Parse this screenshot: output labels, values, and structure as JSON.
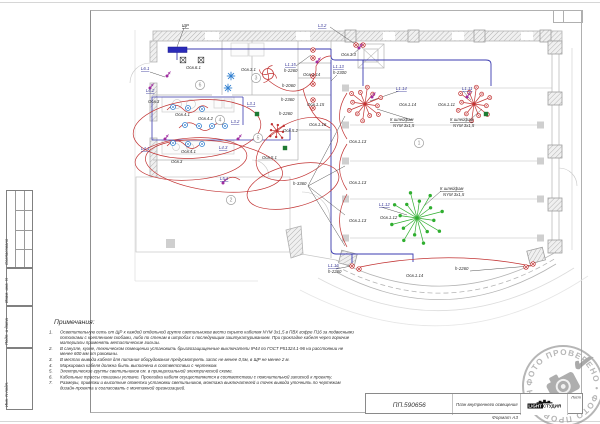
{
  "sheet": {
    "format_label": "Формат А3",
    "corner_box": ""
  },
  "title_block": {
    "doc_number": "ПП.590656",
    "drawing_title": "План внутреннего освещения",
    "logo_word1": "LIGHT",
    "logo_word2": "СТУДИЯ",
    "sheet_cell_label": "Лист"
  },
  "side_stamp": {
    "items": [
      "Согласовано",
      "Взам. инв. N",
      "Подп. и дата",
      "Инв. N подл."
    ]
  },
  "stamp": {
    "text": "ФОТО ПРОВЕРЕНО",
    "icons": [
      "camera-icon",
      "check-icon"
    ]
  },
  "notes": {
    "heading": "Примечания:",
    "items": [
      "Осветительную сеть от ЩР к каждой отдельной группе светильников вести скрыто кабелем NYM 3х1,5 в ПВХ гофре П16 за подвесными потолками с креплением скобами, либо по стенам в штробах с последующим заштукатуриванием. При прокладке кабеля через горючие материалы применять металлические гильзы.",
      "В санузле, кухне, техническом помещении установить брызгозащищенные выключатели IP44 по ГОСТ Р51324.1-96 на расстоянии не менее 600 мм от раковины.",
      "В местах вывода кабеля для питания оборудования предусмотреть запас не менее 0,5м, в ЩР не менее 2 м.",
      "Маркировка кабеля должна быть выполнена в соответствии с чертежом.",
      "Электрические группы светильников см. в принципиальной электрической схеме.",
      "Кабельные трассы показаны условно. Прокладка кабеля осуществляется в соответствии с пояснительной запиской к проекту.",
      "Размеры, привязки и высотные отметки установки светильников, монтажа выключателей и точек вывода уточнить по чертежам дизайн-проекта и согласовать с монтажной организацией."
    ]
  },
  "plan": {
    "colors": {
      "cable_blue": "#3b3bb0",
      "circuit_red": "#c23333",
      "fixture_green": "#2fae2f",
      "switch_magenta": "#a02da0",
      "board_blue": "#2a2ab8"
    },
    "rooms": [
      {
        "n": "1",
        "x": 419,
        "y": 143
      },
      {
        "n": "2",
        "x": 231,
        "y": 200
      },
      {
        "n": "3",
        "x": 256,
        "y": 78
      },
      {
        "n": "4",
        "x": 220,
        "y": 120
      },
      {
        "n": "5",
        "x": 258,
        "y": 138
      },
      {
        "n": "6",
        "x": 200,
        "y": 85
      }
    ],
    "labels": [
      {
        "t": "ЩР",
        "x": 182,
        "y": 27,
        "u": 1
      },
      {
        "t": "L3.2",
        "x": 318,
        "y": 27,
        "u": 1,
        "c": "b"
      },
      {
        "t": "Осв.3.3",
        "x": 341,
        "y": 56
      },
      {
        "t": "Осв.6.1",
        "x": 186,
        "y": 69
      },
      {
        "t": "L6.1",
        "x": 141,
        "y": 70,
        "u": 1,
        "c": "b"
      },
      {
        "t": "L6.2",
        "x": 146,
        "y": 92,
        "u": 1,
        "c": "b"
      },
      {
        "t": "Осв.3.1",
        "x": 241,
        "y": 71
      },
      {
        "t": "L1.15",
        "x": 285,
        "y": 66,
        "u": 1,
        "c": "b"
      },
      {
        "t": "h-2260",
        "x": 284,
        "y": 72
      },
      {
        "t": "h-2060",
        "x": 282,
        "y": 87
      },
      {
        "t": "h-2360",
        "x": 281,
        "y": 101
      },
      {
        "t": "h-2260",
        "x": 279,
        "y": 115
      },
      {
        "t": "Осв.1.14",
        "x": 303,
        "y": 76
      },
      {
        "t": "Осв.1.15",
        "x": 307,
        "y": 106
      },
      {
        "t": "Осв.1.16",
        "x": 309,
        "y": 126
      },
      {
        "t": "L1.13",
        "x": 333,
        "y": 68,
        "u": 1,
        "c": "b"
      },
      {
        "t": "h-2300",
        "x": 333,
        "y": 74
      },
      {
        "t": "Осв.3",
        "x": 148,
        "y": 103
      },
      {
        "t": "Осв.4.1",
        "x": 175,
        "y": 116
      },
      {
        "t": "Осв.4.2",
        "x": 198,
        "y": 120
      },
      {
        "t": "L3.1",
        "x": 247,
        "y": 105,
        "u": 1,
        "c": "b"
      },
      {
        "t": "L3.2",
        "x": 231,
        "y": 123,
        "u": 1,
        "c": "b"
      },
      {
        "t": "Осв.5.2",
        "x": 283,
        "y": 132
      },
      {
        "t": "L4.1",
        "x": 141,
        "y": 150,
        "u": 1,
        "c": "b"
      },
      {
        "t": "Осв.4.1",
        "x": 181,
        "y": 153
      },
      {
        "t": "L4.3",
        "x": 219,
        "y": 149,
        "u": 1,
        "c": "b"
      },
      {
        "t": "Осв.3",
        "x": 171,
        "y": 163
      },
      {
        "t": "Осв.5.1",
        "x": 262,
        "y": 159
      },
      {
        "t": "L5.1",
        "x": 220,
        "y": 180,
        "u": 1,
        "c": "b"
      },
      {
        "t": "L1.14",
        "x": 396,
        "y": 90,
        "u": 1,
        "c": "b"
      },
      {
        "t": "Осв.1.14",
        "x": 399,
        "y": 106
      },
      {
        "t": "К шлейфам",
        "x": 390,
        "y": 121,
        "u": 1
      },
      {
        "t": "NYM 3х1,5",
        "x": 393,
        "y": 127
      },
      {
        "t": "L1.11",
        "x": 462,
        "y": 90,
        "u": 1,
        "c": "b"
      },
      {
        "t": "Осв.1.11",
        "x": 438,
        "y": 106
      },
      {
        "t": "К шлейфам",
        "x": 450,
        "y": 121,
        "u": 1
      },
      {
        "t": "NYM 3х1,5",
        "x": 453,
        "y": 127
      },
      {
        "t": "Осв.1.13",
        "x": 349,
        "y": 143
      },
      {
        "t": "Осв.1.13",
        "x": 349,
        "y": 184
      },
      {
        "t": "Осв.1.13",
        "x": 349,
        "y": 222
      },
      {
        "t": "h-3360",
        "x": 293,
        "y": 185
      },
      {
        "t": "L1.12",
        "x": 379,
        "y": 206,
        "u": 1,
        "c": "b"
      },
      {
        "t": "Осв.1.12",
        "x": 380,
        "y": 219
      },
      {
        "t": "К шлейфам",
        "x": 440,
        "y": 190,
        "u": 1
      },
      {
        "t": "NYM 3х1,5",
        "x": 443,
        "y": 196
      },
      {
        "t": "L1.16",
        "x": 328,
        "y": 267,
        "u": 1,
        "c": "b"
      },
      {
        "t": "h-2260",
        "x": 328,
        "y": 273
      },
      {
        "t": "Осв.1.14",
        "x": 406,
        "y": 277
      },
      {
        "t": "h-2260",
        "x": 455,
        "y": 270
      }
    ],
    "fixtures": {
      "wall_lights": [
        [
          313,
          50
        ],
        [
          313,
          58
        ],
        [
          313,
          76
        ],
        [
          313,
          84
        ],
        [
          313,
          100
        ],
        [
          313,
          108
        ],
        [
          356,
          45
        ],
        [
          363,
          45
        ],
        [
          352,
          266
        ],
        [
          359,
          269
        ],
        [
          526,
          267
        ],
        [
          533,
          264
        ]
      ],
      "downlights": [
        [
          173,
          107
        ],
        [
          188,
          108
        ],
        [
          202,
          109
        ],
        [
          185,
          125
        ],
        [
          199,
          126
        ],
        [
          212,
          126
        ],
        [
          225,
          126
        ],
        [
          173,
          143
        ],
        [
          188,
          144
        ],
        [
          202,
          144
        ]
      ],
      "asterisks": [
        [
          231,
          76
        ],
        [
          228,
          88
        ]
      ],
      "switches": [
        [
          167,
          76
        ],
        [
          150,
          88
        ],
        [
          165,
          139
        ],
        [
          238,
          139
        ],
        [
          223,
          183
        ],
        [
          359,
          48
        ],
        [
          372,
          97
        ],
        [
          467,
          97
        ],
        [
          317,
          62
        ]
      ],
      "junction_boxes_black": [
        [
          183,
          60
        ],
        [
          201,
          60
        ]
      ],
      "junction_boxes_green": [
        [
          257,
          114
        ],
        [
          285,
          148
        ],
        [
          486,
          114
        ]
      ],
      "red_chandeliers": [
        [
          365,
          104
        ],
        [
          474,
          104
        ]
      ],
      "small_red_chandeliers": [
        [
          277,
          131
        ]
      ],
      "green_chandeliers": [
        [
          417,
          218
        ]
      ],
      "fans": [
        [
          268,
          74
        ]
      ]
    }
  }
}
